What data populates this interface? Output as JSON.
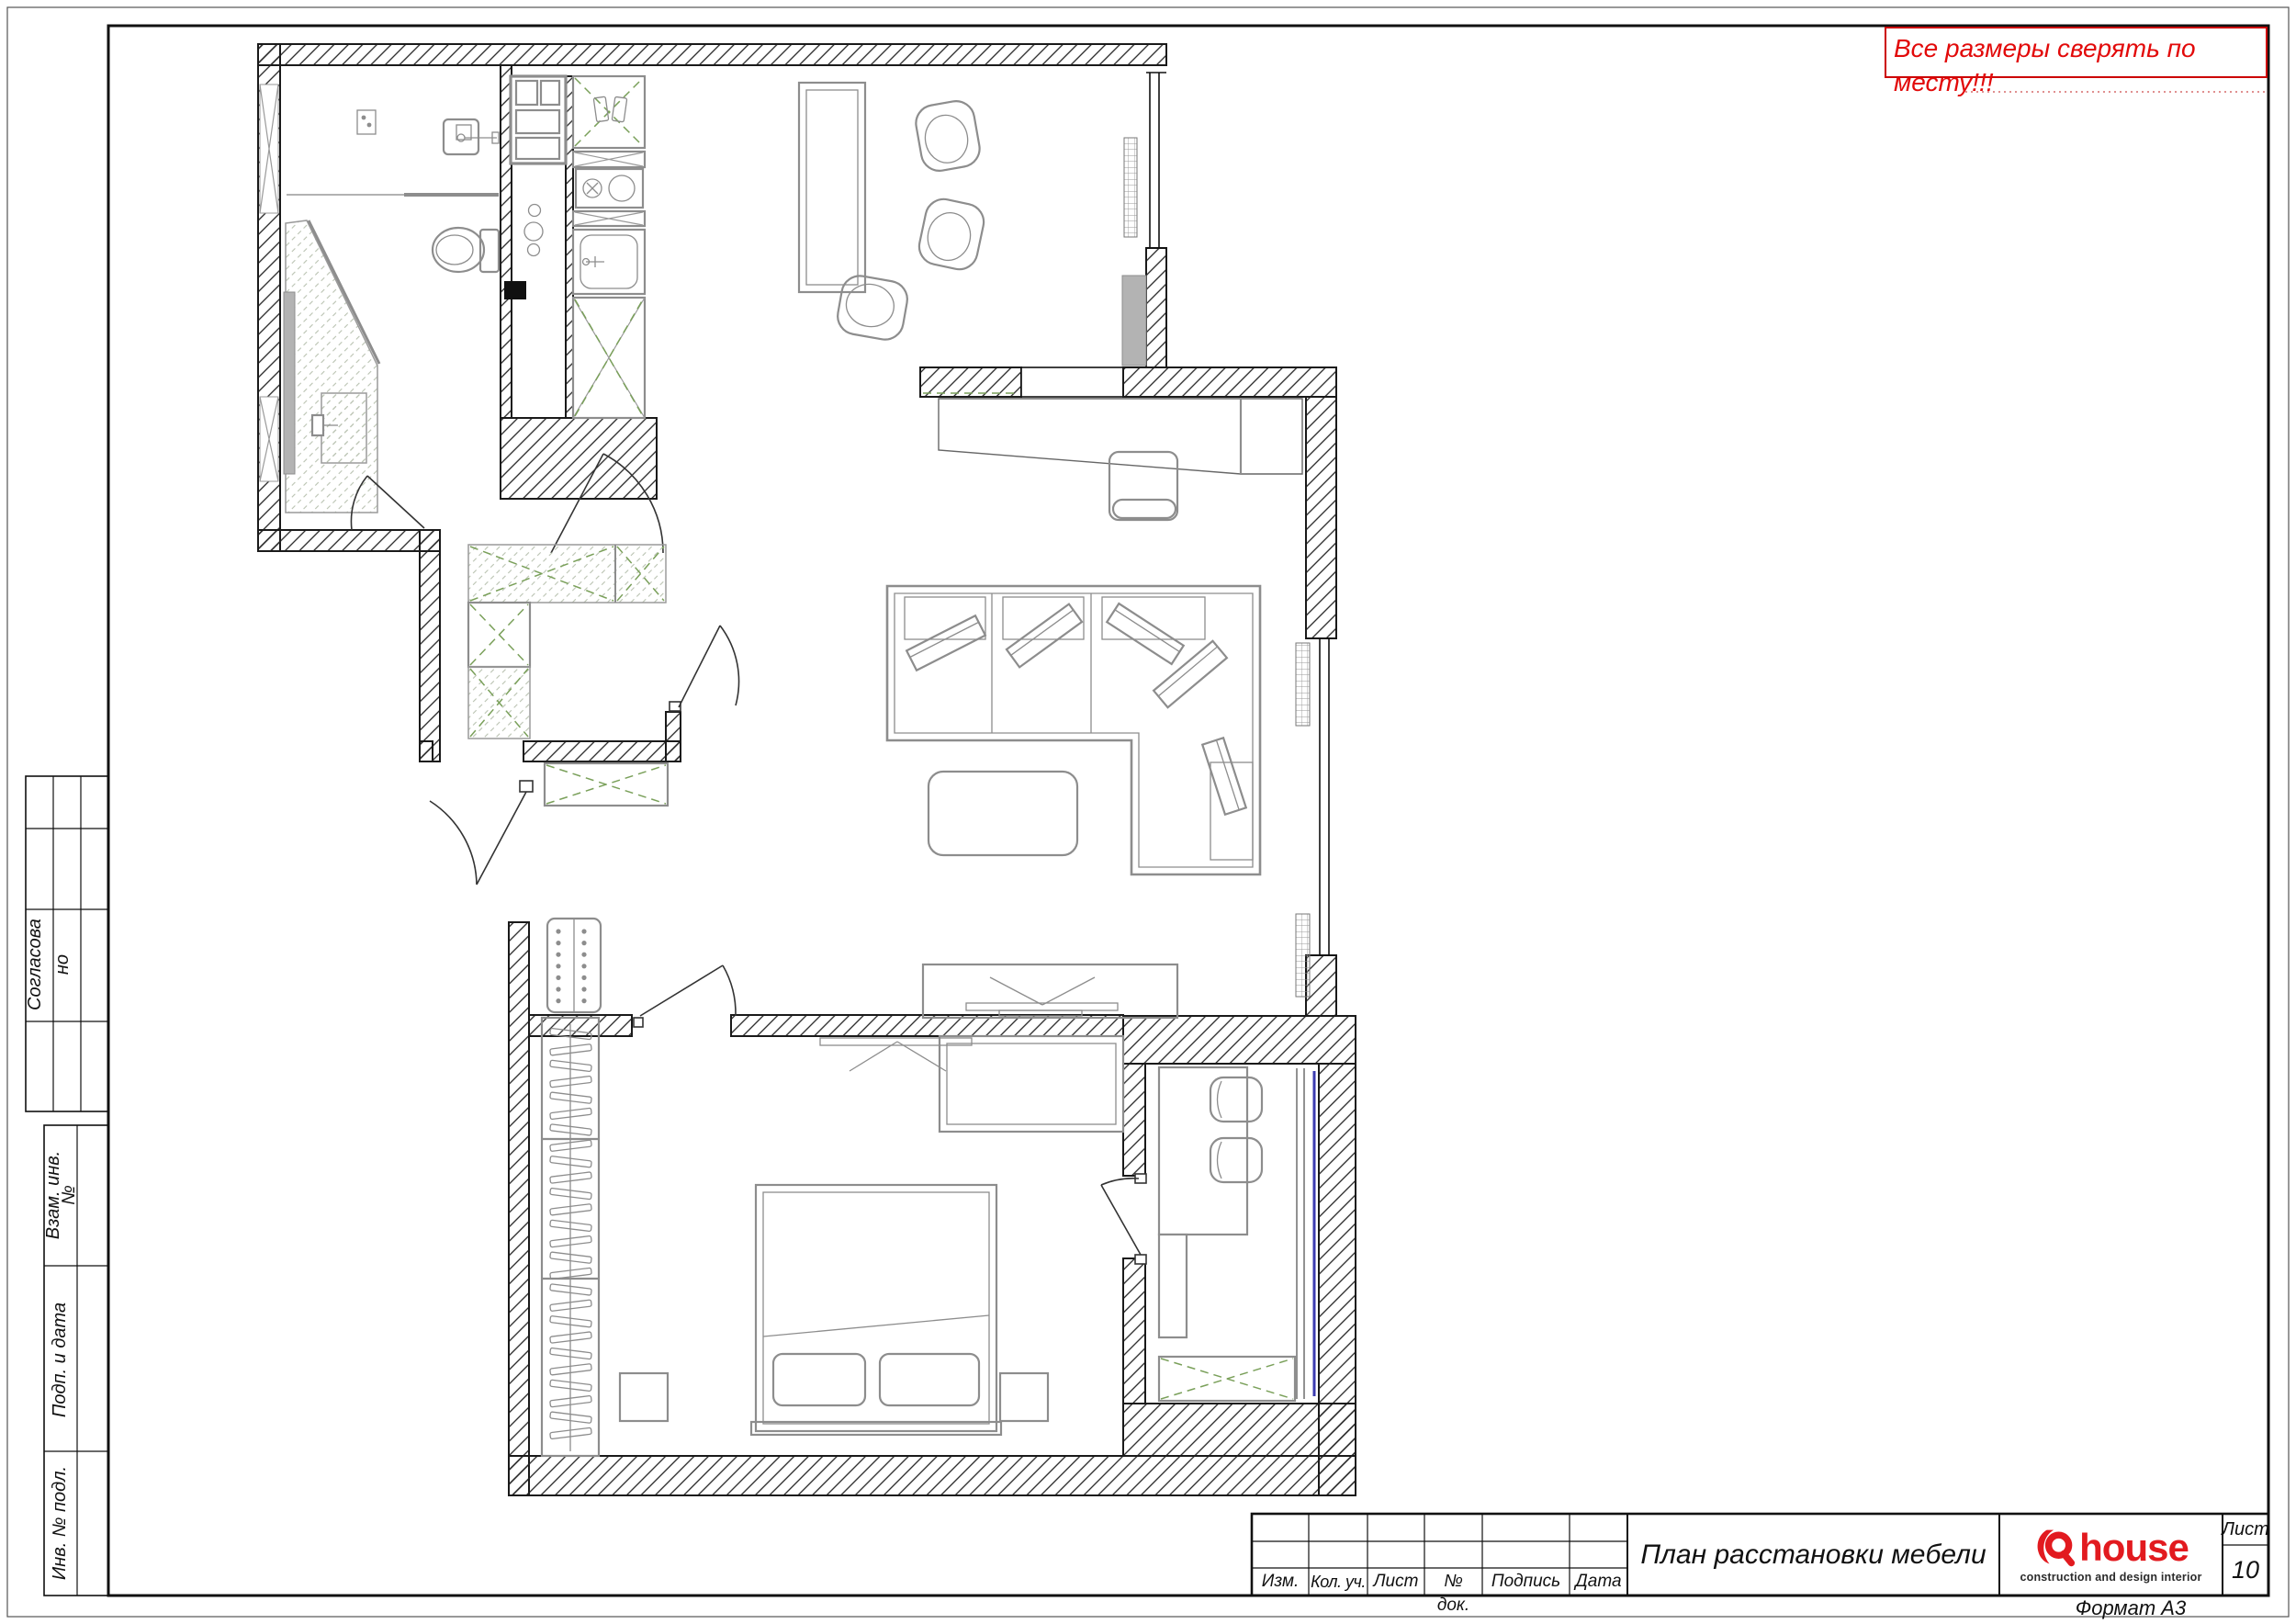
{
  "sheet": {
    "note": "Все размеры сверять по месту!!!",
    "format_note": "Формат А3"
  },
  "left_stamp": {
    "approved_line1": "Согласова",
    "approved_line2": "но",
    "vzam_line1": "Взам. инв.",
    "vzam_line2": "№",
    "podp": "Подп. и дата",
    "inv": "Инв. № подл."
  },
  "title_block": {
    "title": "План расстановки мебели",
    "columns": {
      "izm": "Изм.",
      "kol": "Кол. уч.",
      "list": "Лист",
      "doc1": "№",
      "doc2": "док.",
      "podpis": "Подпись",
      "data": "Дата"
    },
    "sheet_label": "Лист",
    "sheet_number": "10",
    "logo": {
      "name": "house",
      "tagline": "construction and design interior"
    }
  },
  "colors": {
    "note_red": "#e20a0a",
    "logo_red": "#e21a1f",
    "closet_green": "#7aa05a",
    "glazing_blue": "#3b3bb0",
    "furniture_gray": "#8d8d8d",
    "wall_black": "#1a1a1a"
  }
}
